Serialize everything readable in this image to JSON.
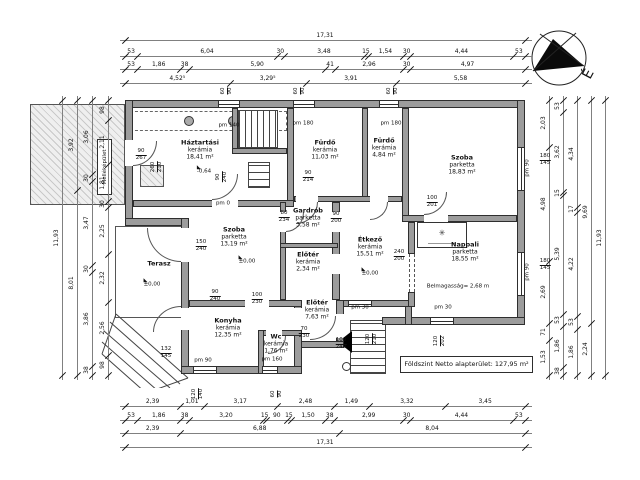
{
  "plan": {
    "summary_box": "Földszint Netto alapterület: 127,95 m²",
    "north_label": "É",
    "outbuilding_label": "Melléképület",
    "colors": {
      "wall_fill": "#9c9c9c",
      "line": "#2e2e2e",
      "hatch_bg": "#efefef"
    },
    "rooms": [
      {
        "name": "Háztartási",
        "material": "kerámia",
        "area": "18,41 m²",
        "x": 200,
        "y": 150
      },
      {
        "name": "Fürdő",
        "material": "kerámia",
        "area": "11,03 m²",
        "x": 325,
        "y": 150
      },
      {
        "name": "Fürdő",
        "material": "kerámia",
        "area": "4,84 m²",
        "x": 384,
        "y": 148
      },
      {
        "name": "Szoba",
        "material": "parketta",
        "area": "18,83 m²",
        "x": 462,
        "y": 165
      },
      {
        "name": "Gardrób",
        "material": "parketta",
        "area": "3,58 m²",
        "x": 308,
        "y": 218
      },
      {
        "name": "Előtér",
        "material": "kerámia",
        "area": "2,34 m²",
        "x": 308,
        "y": 262
      },
      {
        "name": "Étkező",
        "material": "kerámia",
        "area": "15,51 m²",
        "x": 370,
        "y": 247
      },
      {
        "name": "Nappali",
        "material": "parketta",
        "area": "18,55 m²",
        "x": 465,
        "y": 252
      },
      {
        "name": "Szoba",
        "material": "parketta",
        "area": "13,19 m²",
        "x": 234,
        "y": 237
      },
      {
        "name": "Terasz",
        "material": "",
        "area": "",
        "x": 159,
        "y": 264
      },
      {
        "name": "Konyha",
        "material": "kerámia",
        "area": "12,35 m²",
        "x": 228,
        "y": 328
      },
      {
        "name": "Wc",
        "material": "kerámia",
        "area": "1,76 m²",
        "x": 276,
        "y": 344
      },
      {
        "name": "Előtér",
        "material": "kerámia",
        "area": "7,63 m²",
        "x": 317,
        "y": 310
      }
    ],
    "annotations": [
      {
        "t": "pm 140",
        "x": 229,
        "y": 126
      },
      {
        "t": "pm 180",
        "x": 303,
        "y": 124
      },
      {
        "t": "pm 180",
        "x": 391,
        "y": 124
      },
      {
        "t": "pm 0",
        "x": 223,
        "y": 204
      },
      {
        "t": "pm 90",
        "x": 528,
        "y": 168,
        "rot": 1
      },
      {
        "t": "pm 90",
        "x": 528,
        "y": 272,
        "rot": 1
      },
      {
        "t": "180",
        "b": "145",
        "x": 545,
        "y": 160,
        "frac": 1
      },
      {
        "t": "180",
        "b": "145",
        "x": 545,
        "y": 265,
        "frac": 1
      },
      {
        "t": "±0,00",
        "x": 370,
        "y": 272,
        "lvl": 1
      },
      {
        "t": "±0,00",
        "x": 152,
        "y": 283,
        "lvl": 1
      },
      {
        "t": "±0,00",
        "x": 247,
        "y": 260,
        "lvl": 1
      },
      {
        "t": "-0,64",
        "x": 204,
        "y": 170,
        "lvl": 1
      },
      {
        "t": "Belmagasság= 2,68 m",
        "x": 458,
        "y": 287
      },
      {
        "t": "90",
        "b": "267",
        "x": 141,
        "y": 155,
        "frac": 1
      },
      {
        "t": "260",
        "b": "210",
        "x": 157,
        "y": 167,
        "frac": 1,
        "rot": 1
      },
      {
        "t": "90",
        "b": "240",
        "x": 222,
        "y": 177,
        "frac": 1,
        "rot": 1
      },
      {
        "t": "90",
        "b": "214",
        "x": 308,
        "y": 177,
        "frac": 1
      },
      {
        "t": "90",
        "b": "200",
        "x": 336,
        "y": 218,
        "frac": 1
      },
      {
        "t": "80",
        "b": "234",
        "x": 284,
        "y": 217,
        "frac": 1
      },
      {
        "t": "100",
        "b": "201",
        "x": 432,
        "y": 202,
        "frac": 1
      },
      {
        "t": "240",
        "b": "200",
        "x": 399,
        "y": 256,
        "frac": 1
      },
      {
        "t": "150",
        "b": "240",
        "x": 201,
        "y": 246,
        "frac": 1
      },
      {
        "t": "90",
        "b": "240",
        "x": 215,
        "y": 296,
        "frac": 1
      },
      {
        "t": "100",
        "b": "230",
        "x": 257,
        "y": 299,
        "frac": 1
      },
      {
        "t": "70",
        "b": "230",
        "x": 304,
        "y": 333,
        "frac": 1
      },
      {
        "t": "100",
        "b": "240",
        "x": 341,
        "y": 344,
        "frac": 1
      },
      {
        "t": "120",
        "b": "210",
        "x": 372,
        "y": 339,
        "frac": 1,
        "rot": 1
      },
      {
        "t": "120",
        "b": "202",
        "x": 440,
        "y": 341,
        "frac": 1,
        "rot": 1
      },
      {
        "t": "pm 30",
        "x": 360,
        "y": 308
      },
      {
        "t": "pm 30",
        "x": 443,
        "y": 308
      },
      {
        "t": "pm 90",
        "x": 203,
        "y": 361
      },
      {
        "t": "pm 160",
        "x": 272,
        "y": 360
      },
      {
        "t": "132",
        "b": "145",
        "x": 166,
        "y": 353,
        "frac": 1
      },
      {
        "t": "60",
        "b": "90",
        "x": 227,
        "y": 91,
        "frac": 1,
        "rot": 1
      },
      {
        "t": "60",
        "b": "90",
        "x": 300,
        "y": 91,
        "frac": 1,
        "rot": 1
      },
      {
        "t": "60",
        "b": "90",
        "x": 393,
        "y": 91,
        "frac": 1,
        "rot": 1
      },
      {
        "t": "120",
        "b": "140",
        "x": 198,
        "y": 394,
        "frac": 1,
        "rot": 1
      },
      {
        "t": "60",
        "b": "90",
        "x": 277,
        "y": 394,
        "frac": 1,
        "rot": 1
      }
    ],
    "dims": {
      "top": [
        {
          "pos": 40,
          "v": [
            "17,31"
          ]
        },
        {
          "pos": 56,
          "v": [
            "53",
            "6,04",
            "30",
            "3,48",
            "15",
            "1,54",
            "30",
            "4,44",
            "53"
          ]
        },
        {
          "pos": 69,
          "v": [
            "53",
            "1,86",
            "38",
            "5,90",
            "41",
            "2,96",
            "30",
            "4,97"
          ]
        },
        {
          "pos": 83,
          "v": [
            "4,52⁵",
            "3,29⁵",
            "3,91",
            "5,58"
          ]
        }
      ],
      "bottom": [
        {
          "pos": 406,
          "v": [
            "2,39",
            "1,01",
            "3,17",
            "2,48",
            "1,49",
            "3,32",
            "3,45"
          ]
        },
        {
          "pos": 420,
          "v": [
            "53",
            "1,86",
            "38",
            "3,20",
            "15",
            "90",
            "15",
            "1,50",
            "38",
            "2,99",
            "30",
            "4,44",
            "53"
          ]
        },
        {
          "pos": 433,
          "v": [
            "2,39",
            "6,88",
            "8,04"
          ]
        },
        {
          "pos": 447,
          "v": [
            "17,31"
          ]
        }
      ],
      "left": [
        {
          "pos": 62,
          "v": [
            "11,93"
          ]
        },
        {
          "pos": 77,
          "v": [
            "3,92",
            "8,01"
          ]
        },
        {
          "pos": 92,
          "v": [
            "3,06",
            "30",
            "3,47",
            "30",
            "3,86",
            "38"
          ]
        },
        {
          "pos": 108,
          "v": [
            "98",
            "2,11",
            "1,81",
            "30",
            "2,25",
            "2,32",
            "2,56",
            "98"
          ]
        }
      ],
      "right": [
        {
          "pos": 549,
          "v": [
            "2,03",
            "4,98",
            "2,69",
            "71",
            "1,53"
          ]
        },
        {
          "pos": 563,
          "v": [
            "53",
            "3,62",
            "15",
            "5,39",
            "53",
            "1,86",
            "38"
          ]
        },
        {
          "pos": 577,
          "v": [
            "4,34",
            "17",
            "4,22",
            "53",
            "1,86"
          ]
        },
        {
          "pos": 591,
          "v": [
            "9,69",
            "2,24"
          ]
        },
        {
          "pos": 605,
          "v": [
            "11,93"
          ]
        }
      ]
    }
  }
}
